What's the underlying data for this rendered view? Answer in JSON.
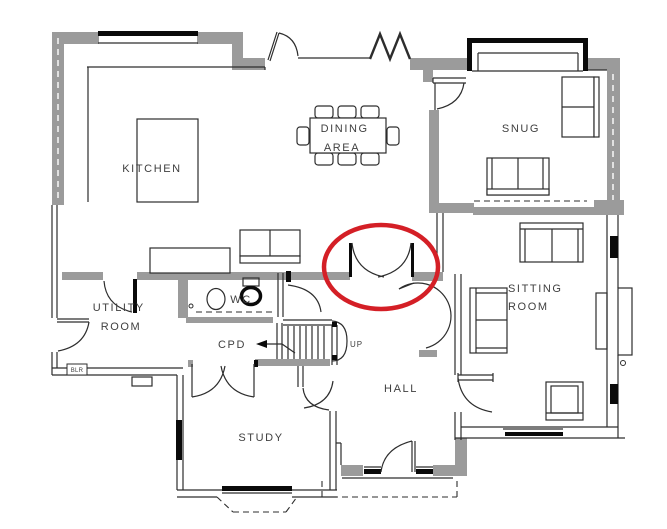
{
  "title": "Ground floor plan",
  "colors": {
    "wall_gray": "#9b9b9b",
    "line": "#2d2d2d",
    "window_black": "#0a0a0a",
    "highlight_red": "#d41f26",
    "paper": "#ffffff"
  },
  "rooms": {
    "kitchen": {
      "label": "KITCHEN"
    },
    "dining_area": {
      "line1": "DINING",
      "line2": "AREA"
    },
    "snug": {
      "label": "SNUG"
    },
    "sitting_room": {
      "line1": "SITTING",
      "line2": "ROOM"
    },
    "utility_room": {
      "line1": "UTILITY",
      "line2": "ROOM"
    },
    "wc": {
      "label": "WC"
    },
    "cupboard": {
      "label": "CPD"
    },
    "hall": {
      "label": "HALL"
    },
    "study": {
      "label": "STUDY"
    }
  },
  "stairs": {
    "direction": "UP"
  },
  "boiler": {
    "label": "BLR"
  },
  "highlight": {
    "shape": "ellipse",
    "color": "#d41f26",
    "marks": "double doors between dining area and hall"
  }
}
